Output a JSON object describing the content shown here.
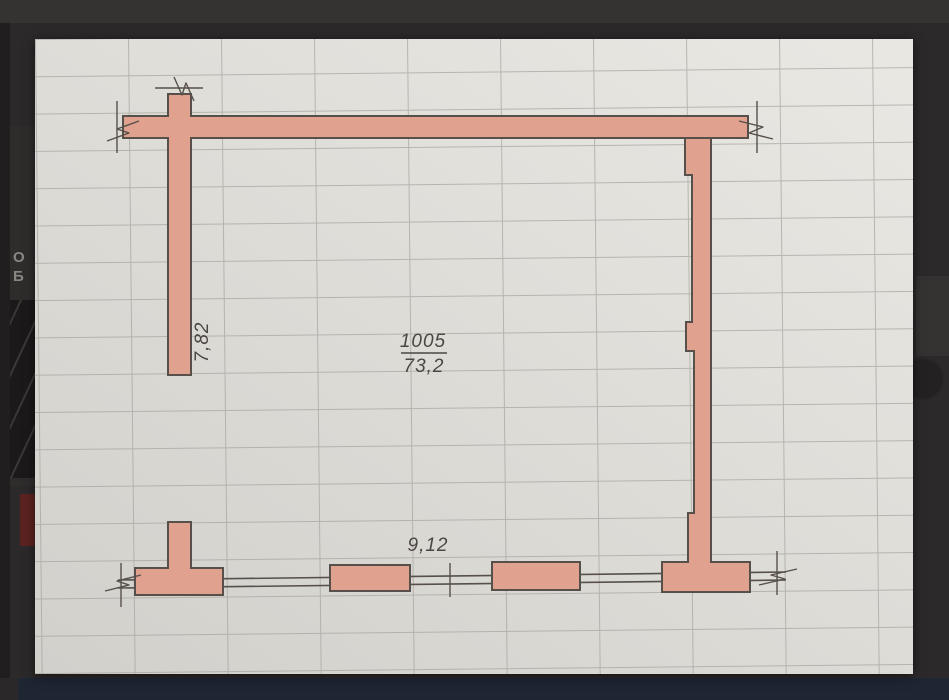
{
  "photo_viewer": {
    "background_fragments": {
      "text_line1": "О",
      "text_line2": "Б"
    }
  },
  "floor_plan": {
    "room_number": "1005",
    "room_area": "73,2",
    "dim_vertical": "7,82",
    "dim_horizontal": "9,12"
  },
  "colors": {
    "bg": "#2b2929",
    "bg_top": "#353232",
    "panel": "#2f2c2c",
    "thumb": "#1b1919",
    "red_frag": "#5c2320",
    "patch": "#353232",
    "navy_bar": "#1e2533",
    "paper_light": "#e9e7e2",
    "paper_dark": "#d2d0cb",
    "grid_line": "#a9a6a1",
    "wall_fill": "#e0a28e",
    "wall_stroke": "#57504a",
    "line_color": "#57504a",
    "text_color": "#4b4643",
    "frag_text": "#8a8683"
  }
}
